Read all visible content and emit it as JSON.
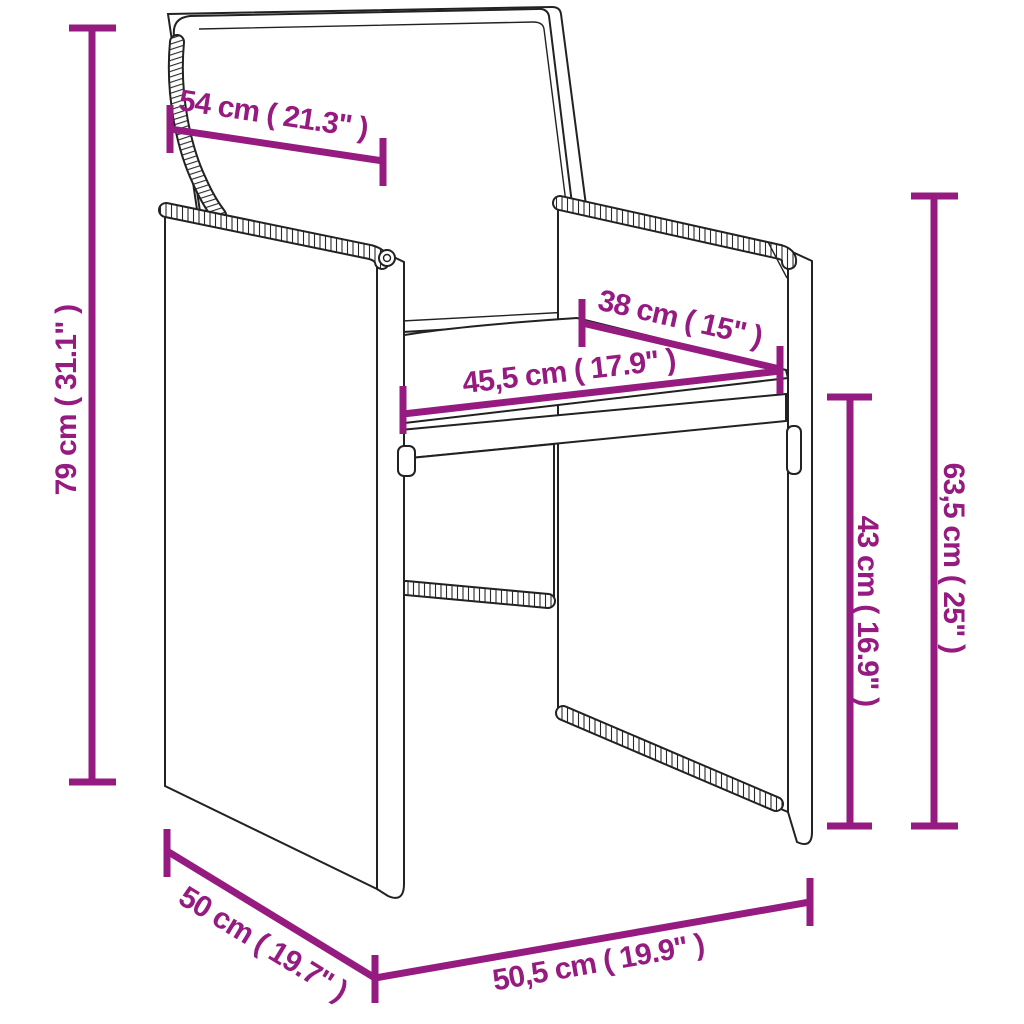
{
  "accent_color": "#951b81",
  "line_color": "#222222",
  "diagram": {
    "subject": "poly-rattan-dining-chair-with-cushions",
    "dimensions": [
      {
        "name": "backrest-width",
        "label": "54 cm ( 21.3\" )"
      },
      {
        "name": "overall-height",
        "label": "79 cm ( 31.1\" )"
      },
      {
        "name": "armrest-depth",
        "label": "38 cm ( 15\" )"
      },
      {
        "name": "seat-width",
        "label": "45,5 cm ( 17.9\" )"
      },
      {
        "name": "seat-height",
        "label": "43 cm ( 16.9\" )"
      },
      {
        "name": "armrest-height",
        "label": "63,5 cm ( 25\" )"
      },
      {
        "name": "seat-depth",
        "label": "50 cm ( 19.7\" )"
      },
      {
        "name": "overall-width",
        "label": "50,5 cm ( 19.9\" )"
      }
    ]
  }
}
